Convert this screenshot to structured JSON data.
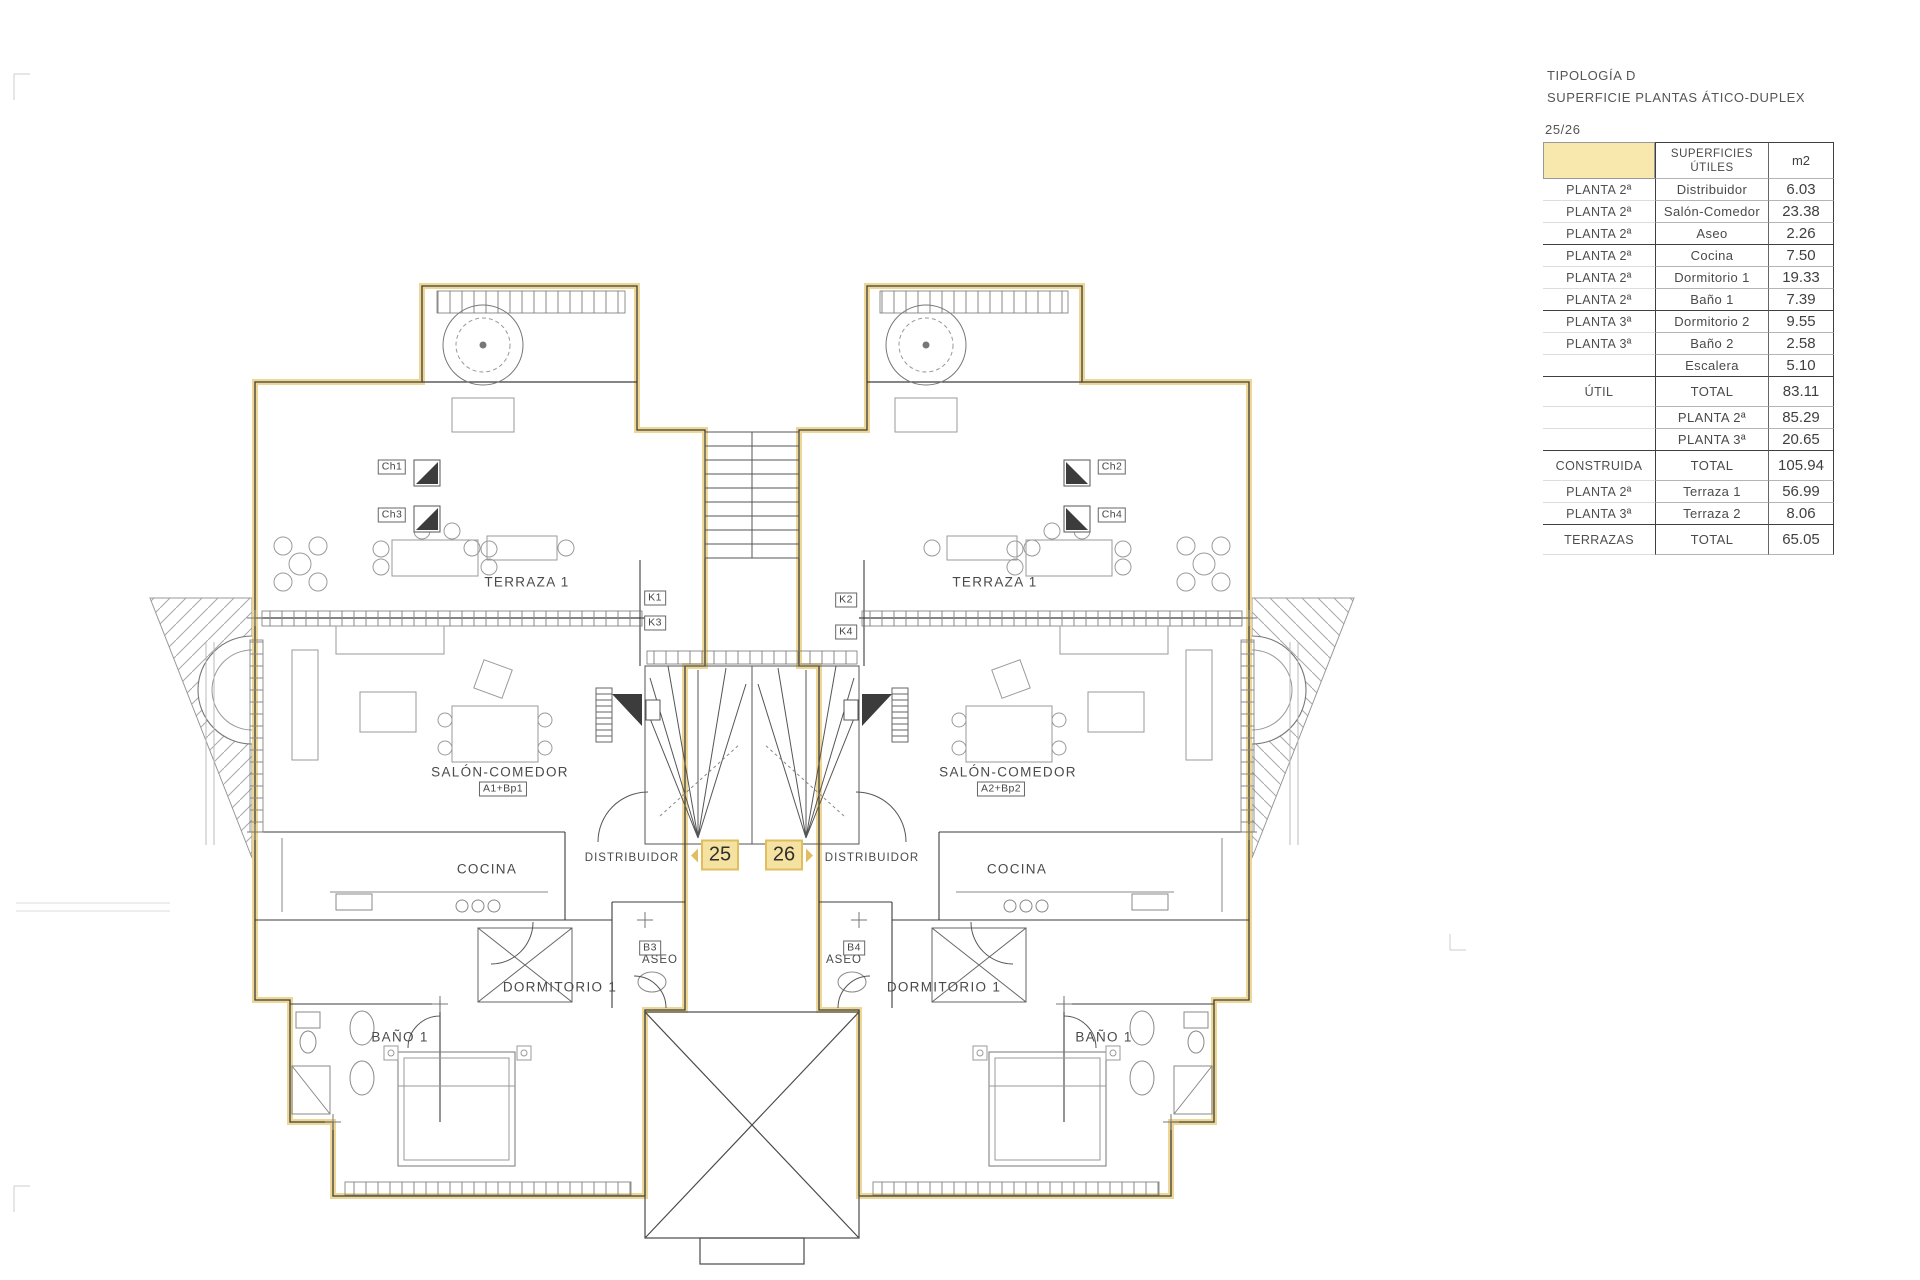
{
  "title_block": {
    "typology": "TIPOLOGÍA D",
    "subtitle": "SUPERFICIE PLANTAS ÁTICO-DUPLEX",
    "units": "25/26"
  },
  "table": {
    "header": {
      "col2_line1": "SUPERFICIES",
      "col2_line2": "ÚTILES",
      "col3": "m2"
    },
    "rows": [
      {
        "c1": "PLANTA 2ª",
        "c2": "Distribuidor",
        "c3": "6.03"
      },
      {
        "c1": "PLANTA 2ª",
        "c2": "Salón-Comedor",
        "c3": "23.38"
      },
      {
        "c1": "PLANTA 2ª",
        "c2": "Aseo",
        "c3": "2.26"
      },
      {
        "c1": "PLANTA 2ª",
        "c2": "Cocina",
        "c3": "7.50"
      },
      {
        "c1": "PLANTA 2ª",
        "c2": "Dormitorio 1",
        "c3": "19.33"
      },
      {
        "c1": "PLANTA 2ª",
        "c2": "Baño 1",
        "c3": "7.39"
      },
      {
        "c1": "PLANTA 3ª",
        "c2": "Dormitorio 2",
        "c3": "9.55"
      },
      {
        "c1": "PLANTA 3ª",
        "c2": "Baño 2",
        "c3": "2.58"
      },
      {
        "c1": "",
        "c2": "Escalera",
        "c3": "5.10"
      },
      {
        "c1": "ÚTIL",
        "c2": "TOTAL",
        "c3": "83.11"
      },
      {
        "c1": "",
        "c2": "PLANTA 2ª",
        "c3": "85.29"
      },
      {
        "c1": "",
        "c2": "PLANTA 3ª",
        "c3": "20.65"
      },
      {
        "c1": "CONSTRUIDA",
        "c2": "TOTAL",
        "c3": "105.94"
      },
      {
        "c1": "PLANTA 2ª",
        "c2": "Terraza 1",
        "c3": "56.99"
      },
      {
        "c1": "PLANTA 3ª",
        "c2": "Terraza 2",
        "c3": "8.06"
      },
      {
        "c1": "TERRAZAS",
        "c2": "TOTAL",
        "c3": "65.05"
      }
    ]
  },
  "plan": {
    "badges": [
      {
        "number": "25"
      },
      {
        "number": "26"
      }
    ],
    "labels": [
      {
        "text": "TERRAZA 1"
      },
      {
        "text": "TERRAZA 1"
      },
      {
        "text": "SALÓN-COMEDOR"
      },
      {
        "text": "SALÓN-COMEDOR"
      },
      {
        "text": "COCINA"
      },
      {
        "text": "COCINA"
      },
      {
        "text": "DISTRIBUIDOR"
      },
      {
        "text": "DISTRIBUIDOR"
      },
      {
        "text": "DORMITORIO 1"
      },
      {
        "text": "DORMITORIO 1"
      },
      {
        "text": "ASEO"
      },
      {
        "text": "ASEO"
      },
      {
        "text": "BAÑO 1"
      },
      {
        "text": "BAÑO 1"
      }
    ],
    "tags": [
      {
        "text": "A1+Bp1"
      },
      {
        "text": "A2+Bp2"
      },
      {
        "text": "K1"
      },
      {
        "text": "K3"
      },
      {
        "text": "K2"
      },
      {
        "text": "K4"
      },
      {
        "text": "Ch1"
      },
      {
        "text": "Ch3"
      },
      {
        "text": "Ch2"
      },
      {
        "text": "Ch4"
      },
      {
        "text": "B3"
      },
      {
        "text": "B4"
      }
    ]
  },
  "colors": {
    "highlight": "#EDD48F",
    "badge_fill": "#F6E2A0",
    "badge_border": "#DFBE62",
    "line": "#3C3C3C"
  }
}
